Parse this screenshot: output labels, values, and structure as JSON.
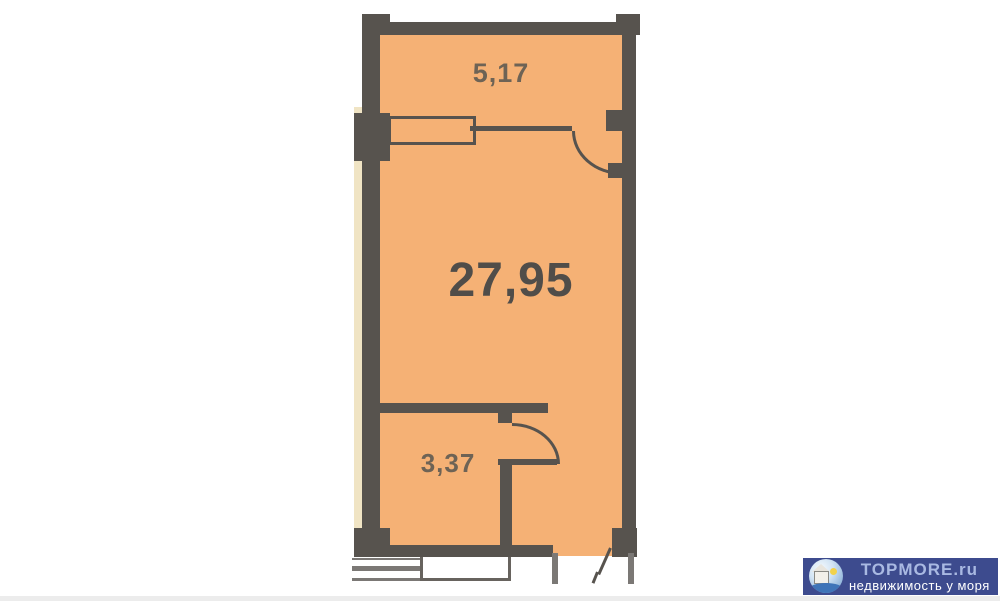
{
  "plan": {
    "rooms": [
      {
        "id": "hallway-top",
        "area": "5,17"
      },
      {
        "id": "main-room",
        "area": "27,95"
      },
      {
        "id": "bathroom",
        "area": "3,37"
      }
    ],
    "colors": {
      "floor": "#f5b175",
      "wall": "#57534e",
      "side_strip": "#f0e4c4",
      "room_label": "#6e6355",
      "main_label": "#504d49"
    }
  },
  "watermark": {
    "title": "TOPMORE.ru",
    "subtitle": "недвижимость у моря",
    "logo_icon": "house-sun-sea-icon",
    "colors": {
      "background": "#3d4b8e",
      "title": "#a9b9e2",
      "subtitle": "#ffffff"
    }
  }
}
